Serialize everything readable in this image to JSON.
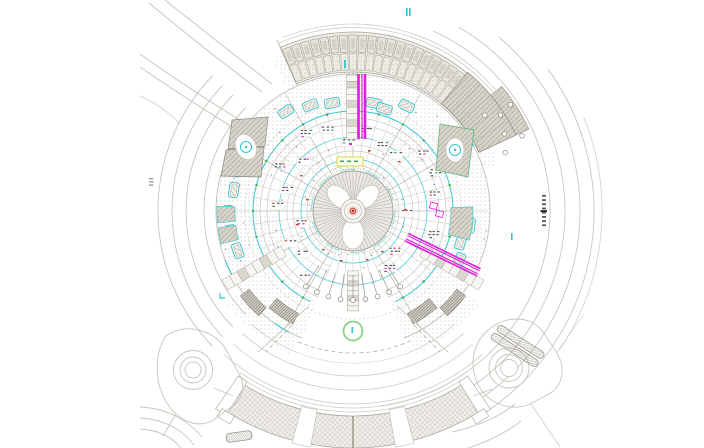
{
  "meta": {
    "type": "CAD site plan drawing viewer",
    "subject": "Circular building complex site plan, top view, with ring roads, canopy bands and central dome",
    "legible_text": "none - all annotations are micro-scale CAD specks"
  },
  "palette": {
    "background": "#ffffff",
    "line_light": "#c9c5bd",
    "line_mid": "#a8a49c",
    "line_dark": "#75716a",
    "band_fill": "#f0eee8",
    "band_cell": "#e7e4db",
    "band_cell_inner": "#d6d2c8",
    "hatch_fill": "#d8d4ca",
    "hatch_line": "#a39f96",
    "stipple_dot": "#b9b5ad",
    "cyan": "#2fc4cf",
    "cyan_dark": "#2a8f98",
    "magenta": "#df1fdf",
    "green": "#86d586",
    "green_dark": "#3fae4f",
    "red": "#c8342a",
    "pink": "#f2d0cc",
    "yellow": "#d8d22a",
    "text_speck": "#45423d"
  },
  "plan": {
    "center_px": {
      "x": 353,
      "y": 211
    },
    "dome_radius_px": 40,
    "dome_spokes": 64,
    "dome_petals": 3,
    "plaza_radius_px": 137,
    "canopy_band_radii_px": [
      139,
      180
    ],
    "building_ring_radii_px": [
      52,
      74,
      100
    ],
    "tree_markers": 9,
    "kiosk_boxes": 14,
    "ramp_loops": 2
  },
  "markers": {
    "info_marker_color": "cyan",
    "utility_run_color": "magenta",
    "landscape_color": "green",
    "survey_center_color": "red"
  }
}
